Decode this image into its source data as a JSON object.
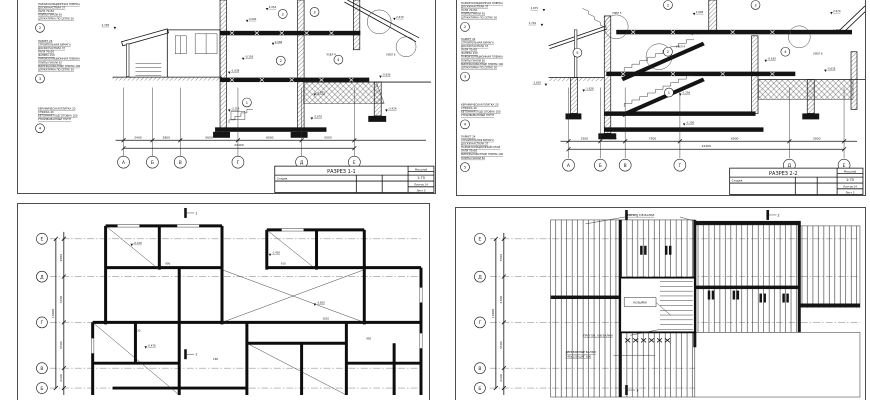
{
  "colors": {
    "ink": "#141414",
    "paper": "#ffffff",
    "frame": "#4d4d4d"
  },
  "sheet1": {
    "name": "РАЗРЕЗ 1-1",
    "notes": [
      {
        "num": "2",
        "lines": [
          "ПАРОИЗОЛЯЦИОННАЯ ПЛЕНКА",
          "ДОСКИ НАСТИЛА 37",
          "ЛАГИ 70х50",
          "ПЛИТЫ ПАКЛИ 50",
          "ШТУКАТУРКА ПО СЕТКЕ 30"
        ]
      },
      {
        "num": "3",
        "lines": [
          "ПАРКЕТ 24",
          "СТРОИТЕЛЬНАЯ БУМАГА",
          "ДОСКИ НАСТИЛА 37",
          "ЛАГИ 70х50",
          "ФАНЕРА 150",
          "ПАРОИЗОЛЯЦИОННАЯ ПЛЕНКА",
          "ПЛИТЫ ПАКЛИ 50",
          "МИНЕРАЛОВАТНЫЕ ПЛИТЫ 100",
          "ШТУКАТУРКА ПО СЕТКЕ 30"
        ]
      },
      {
        "num": "4",
        "lines": [
          "КЕРАМИЧЕСКАЯ ПЛИТКА 20",
          "СТЯЖКА 40",
          "БЕТОННАЯ ПОДГОТОВКА 100",
          "УТРАМБОВАННЫЙ ГРУНТ"
        ]
      }
    ],
    "levels": {
      "porch": "2.728",
      "a": "4.054",
      "b": "3.000",
      "c": "2.048",
      "d": "-0.156",
      "e": "-1.638",
      "f": "-3.214",
      "g": "-0.875",
      "h": "-2.678",
      "i": "-0.636",
      "j": "-3.424",
      "k": "2.670",
      "uzel4": "УЗЕЛ 4",
      "uzel6": "УЗЕЛ 6"
    },
    "nodes": {
      "n1": "1",
      "n2": "2",
      "n3": "3",
      "n4": "4",
      "n2b": "2"
    },
    "grid": [
      "А",
      "Б",
      "В",
      "Г",
      "Д",
      "Е"
    ],
    "dims": [
      "2400",
      "2800",
      "5600",
      "6000",
      "5000"
    ],
    "total": "22400",
    "tb": {
      "scale_label": "Масштаб",
      "scale": "1:75",
      "stage": "Стадия",
      "sheets": "Листов 14",
      "sheet": "Лист 5"
    }
  },
  "sheet2": {
    "name": "РАЗРЕЗ 2-2",
    "notes": [
      {
        "num": "2",
        "lines": [
          "ПАРОИЗОЛЯЦИОННАЯ ПЛЕНКА",
          "ДОСКИ НАСТИЛА 37",
          "ЛАГИ 70х50",
          "ПЛИТЫ ПАКЛИ 50",
          "ШТУКАТУРКА ПО СЕТКЕ 30"
        ]
      },
      {
        "num": "3",
        "lines": [
          "ПАРКЕТ 24",
          "СТРОИТЕЛЬНАЯ БУМАГА",
          "ДОСКИ НАСТИЛА 37",
          "ЛАГИ 70х50",
          "ФАНЕРА 150",
          "ПАРОИЗОЛЯЦИОННАЯ ПЛЕНКА",
          "ПЛИТЫ ПАКЛИ 50",
          "МИНЕРАЛОВАТНЫЕ ПЛИТЫ 100",
          "ШТУКАТУРКА ПО СЕТКЕ 30"
        ]
      },
      {
        "num": "4",
        "lines": [
          "КЕРАМИЧЕСКАЯ ПЛИТКА 20",
          "СТЯЖКА 40",
          "БЕТОННАЯ ПОДГОТОВКА 100",
          "УТРАМБОВАННЫЙ ГРУНТ"
        ]
      },
      {
        "num": "5",
        "lines": [
          "ПАРКЕТ 24",
          "СТРОИТЕЛЬНАЯ БУМАГА",
          "ДОСКИ НАСТИЛА 37",
          "ПАРОИЗОЛЯЦИОННЫЙ СЛОЙ",
          "ЛАГИ 70х50",
          "МИНЕРАЛОВАТНЫЕ ПЛИТЫ 100",
          "ПЛИТЫ ПАКЛИ 50"
        ]
      }
    ],
    "levels": {
      "l1": "2.675",
      "l2": "1.704",
      "l3": "-1.620",
      "m1": "3.048",
      "m2": "0.954",
      "m3": "-1.628",
      "m4": "-1.256",
      "r1": "2.670",
      "r2": "1.296",
      "r3": "-0.630",
      "r4": "-0.636",
      "b1": "-3.206",
      "uzel4": "УЗЕЛ 4",
      "uzel5": "УЗЕЛ 5",
      "uzel6": "УЗЕЛ 6"
    },
    "nodes": {
      "n1": "1",
      "n2": "2",
      "n3": "3",
      "n4": "4",
      "n5": "5",
      "n2b": "2"
    },
    "grid": [
      "А",
      "Б",
      "В",
      "Г",
      "Д",
      "Е"
    ],
    "dims": [
      "2500",
      "1500",
      "7500",
      "6000",
      "3000"
    ],
    "total": "22400",
    "tb": {
      "scale_label": "Масштаб",
      "scale": "1:75",
      "stage": "Стадия",
      "sheets": "Листов 14",
      "sheet": "Лист 5"
    }
  },
  "sheet3": {
    "grid": [
      "Е",
      "Д",
      "Г",
      "В",
      "Б"
    ],
    "dims": [
      "2980",
      "4700",
      "4500",
      "2100"
    ],
    "total": "16000",
    "marker": "1",
    "levels": {
      "v1": "-0.470",
      "v2": "-1.430",
      "v3": "-3.650",
      "v4": "-0.476"
    },
    "small_dims": {
      "d1": "900",
      "d2": "910",
      "d3": "1810",
      "d4": "120",
      "d5": "180",
      "d6": "950"
    }
  },
  "sheet4": {
    "grid": [
      "Е",
      "Д",
      "Г",
      "В",
      "Б"
    ],
    "dims": [
      "3500",
      "4500",
      "4500",
      "2100"
    ],
    "total": "16000",
    "labels": {
      "progon": "ПРОГОН, Х/В БАЛКИ",
      "beams_l1": "ДЕРЕВЯННЫЕ БАЛКИ",
      "beams_l2": "240х120 ШАГ 600",
      "kozyrek": "КОЗЫРЕК"
    },
    "markers": {
      "m1": "1",
      "m2": "2"
    }
  }
}
